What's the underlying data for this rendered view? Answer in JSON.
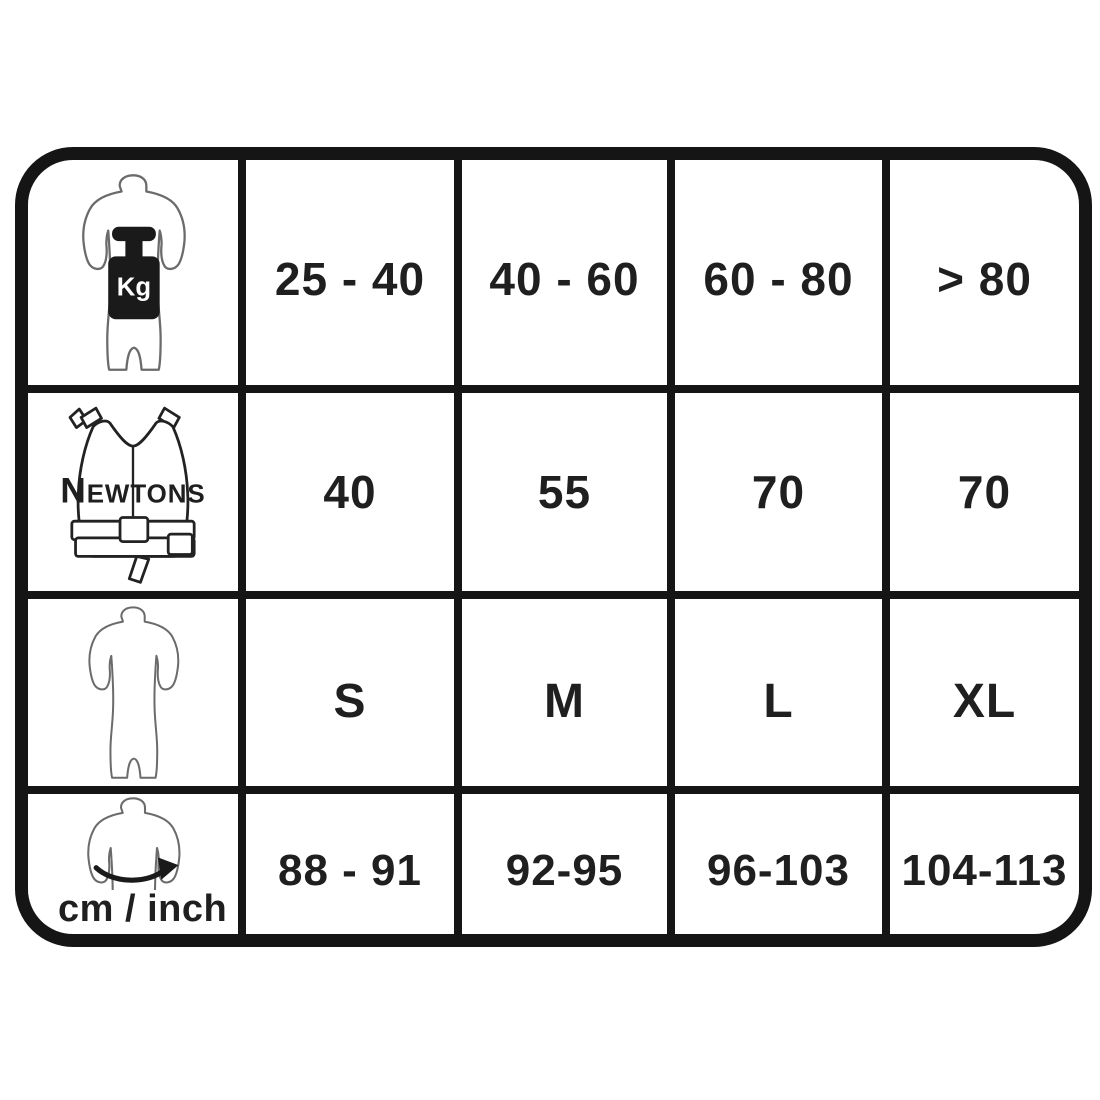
{
  "title": "Buoyancy vest size chart",
  "colors": {
    "line": "#151515",
    "text": "#1f1f1f",
    "bg": "#ffffff",
    "suit-stroke": "#6b6b6b",
    "vest-stroke": "#222222",
    "weight-fill": "#1a1a1a"
  },
  "table": {
    "rows": [
      {
        "id": "body-weight",
        "icon": "body-weight-kg-icon",
        "icon_label": "Kg",
        "values": [
          "25 - 40",
          "40 - 60",
          "60 - 80",
          "> 80"
        ]
      },
      {
        "id": "buoyancy-newtons",
        "icon": "buoyancy-vest-icon",
        "icon_label_parts": [
          "N",
          "EWTONS"
        ],
        "values": [
          "40",
          "55",
          "70",
          "70"
        ]
      },
      {
        "id": "suit-size",
        "icon": "shorty-suit-icon",
        "icon_label": "",
        "values": [
          "S",
          "M",
          "L",
          "XL"
        ]
      },
      {
        "id": "chest-girth",
        "icon": "chest-girth-arrow-icon",
        "icon_label": "cm / inch",
        "values": [
          "88 - 91",
          "92-95",
          "96-103",
          "104-113"
        ]
      }
    ]
  },
  "chart_data": {
    "type": "table",
    "rows": [
      {
        "label": "Kg",
        "values": [
          "25 - 40",
          "40 - 60",
          "60 - 80",
          "> 80"
        ]
      },
      {
        "label": "Newtons",
        "values": [
          "40",
          "55",
          "70",
          "70"
        ]
      },
      {
        "label": "",
        "values": [
          "S",
          "M",
          "L",
          "XL"
        ]
      },
      {
        "label": "cm / inch",
        "values": [
          "88 - 91",
          "92-95",
          "96-103",
          "104-113"
        ]
      }
    ],
    "title": "Buoyancy vest size chart",
    "notes": "Rows keyed by pictograms: body weight (Kg), vest buoyancy (Newtons), suit size, chest girth (cm / inch)"
  }
}
